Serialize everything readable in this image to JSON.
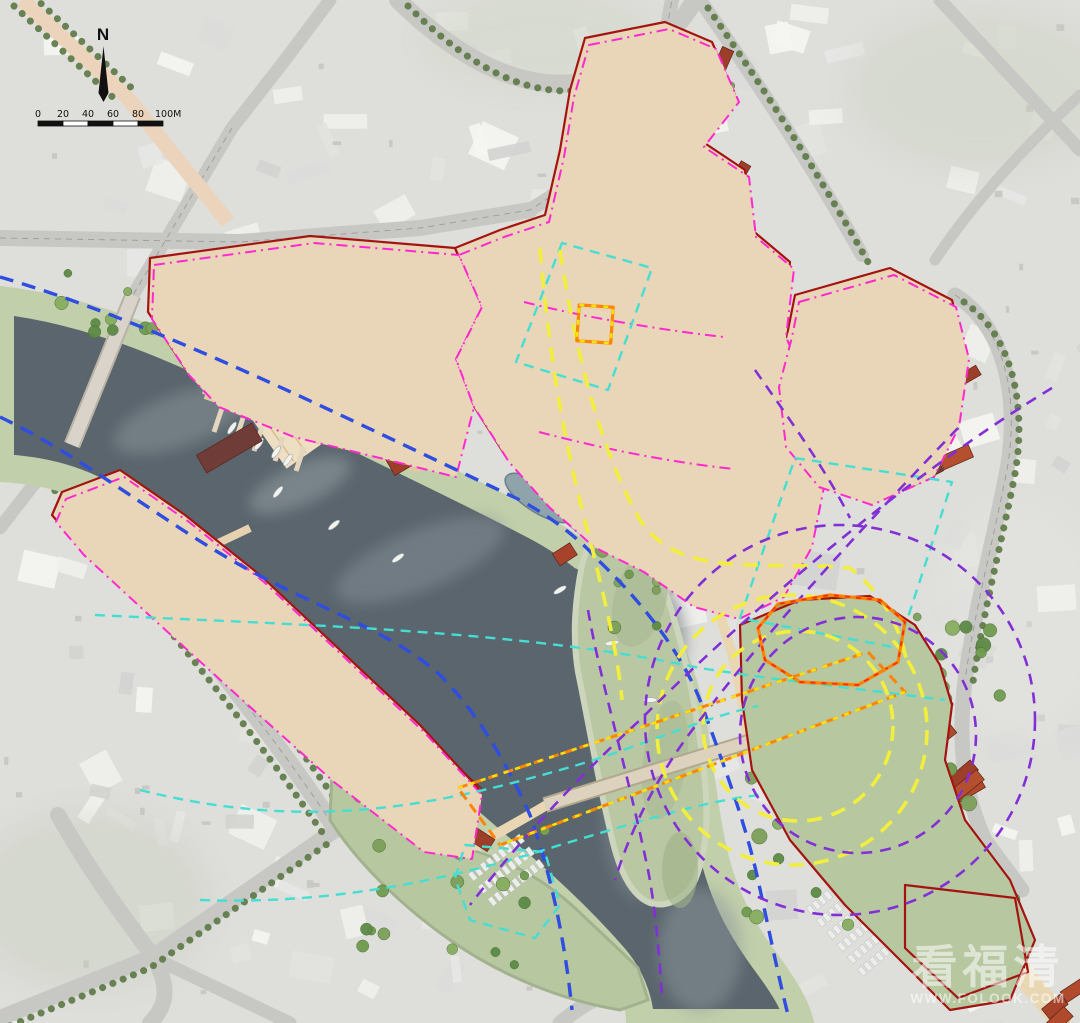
{
  "compass": {
    "label": "N"
  },
  "scale_bar": {
    "ticks": [
      "0",
      "20",
      "40",
      "60",
      "80",
      "100M"
    ]
  },
  "watermark": {
    "brand": "看福清",
    "site": "WWW.FOLOOK.COM"
  },
  "palette": {
    "water": "#5a656d",
    "waterdeep": "#4c575f",
    "bank": "#c2cfab",
    "parkgreen": "#b7c7a0",
    "ground": "#e9d6b8",
    "siteroad": "#e9d7b4",
    "plaza": "#eedfc2",
    "roofa": "#b04a2c",
    "roofb": "#9c3e2a",
    "roofdark": "#6f3c37",
    "citygray": "#dededb",
    "roadgray": "#c7c7c4",
    "boundred": "#a31411",
    "lblue": "#2f4de0",
    "lcyan": "#45ded2",
    "lyellow": "#f2ee3e",
    "lpurple": "#8230d6",
    "lmagenta": "#ff29cf",
    "lorange": "#ff8400",
    "treedark": "#5d7a48",
    "treelight": "#86ad5f"
  }
}
